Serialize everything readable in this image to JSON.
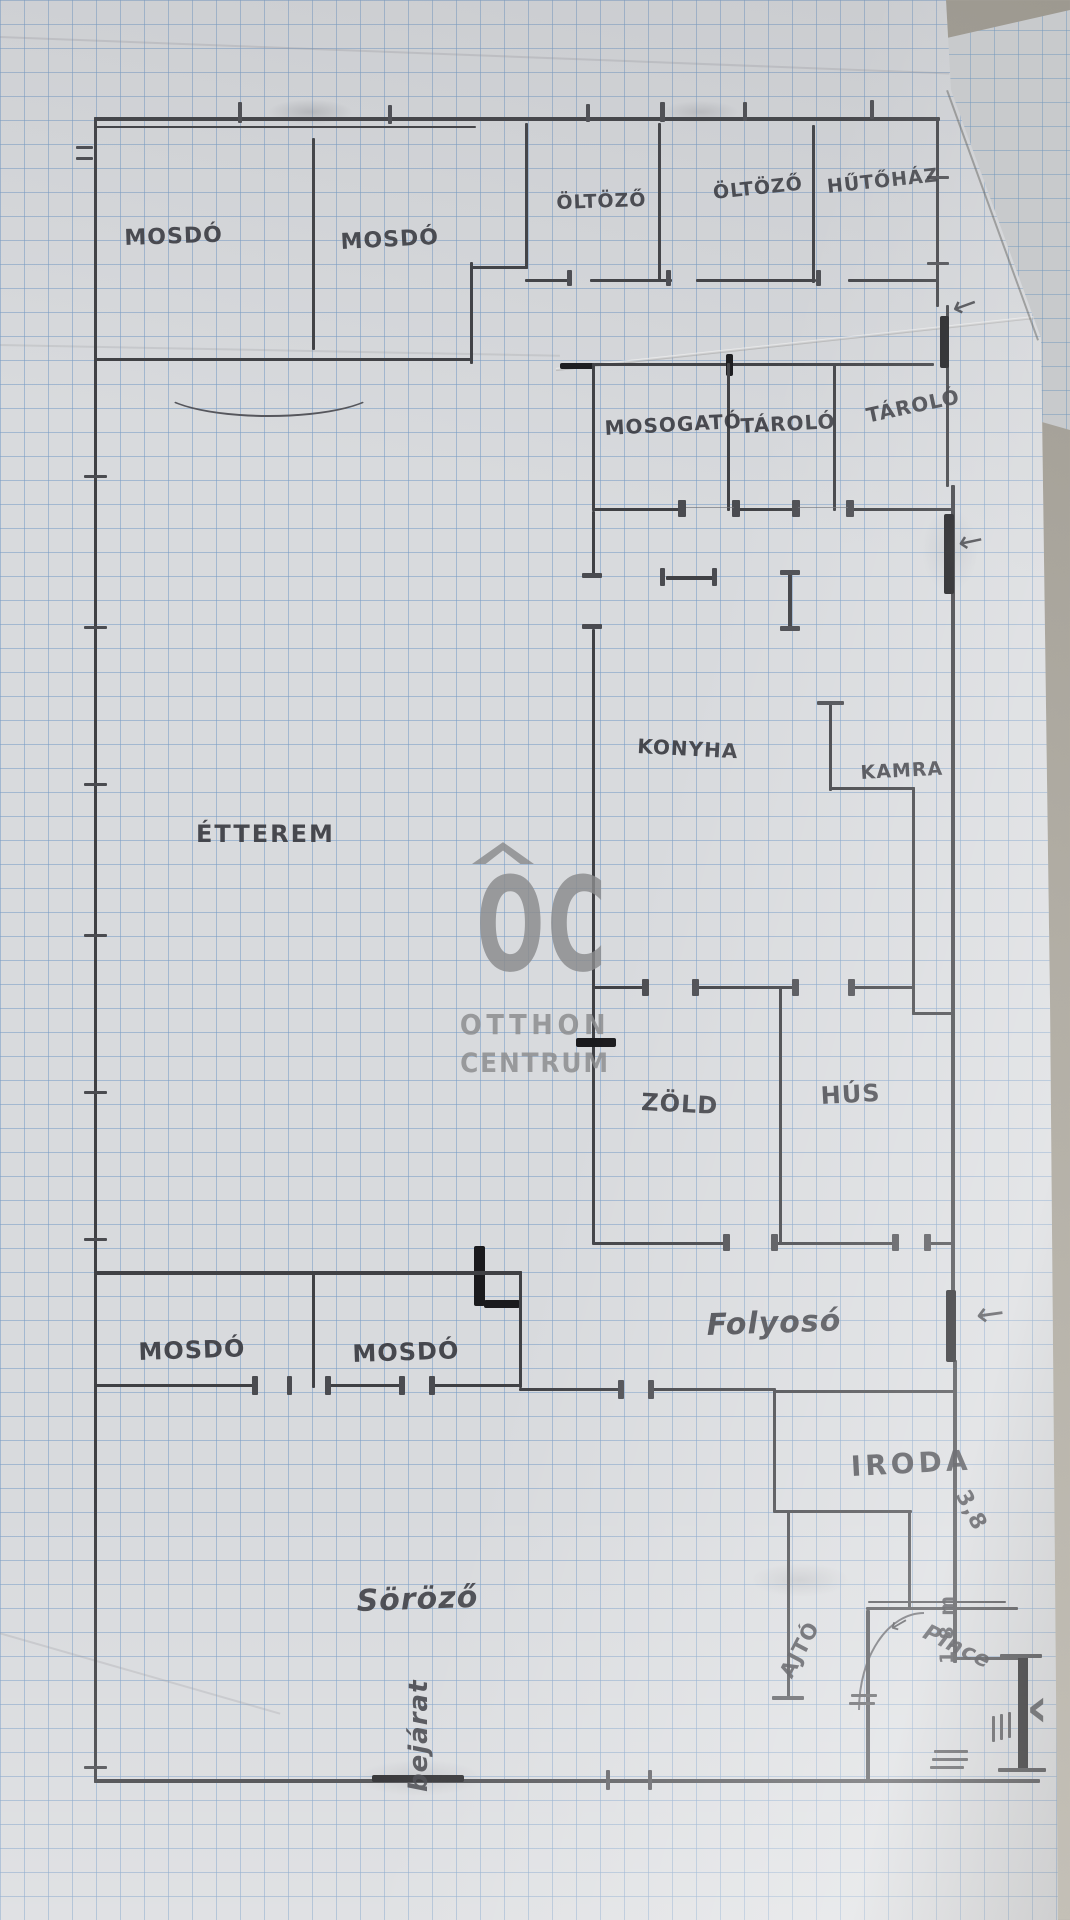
{
  "scene": {
    "description": "Hand-drawn restaurant floor plan sketched in pencil on blue graph paper, photographed lying on a grey table",
    "paper_type": "graph paper"
  },
  "watermark": {
    "mark": "OC",
    "line1": "OTTHON",
    "line2": "CENTRUM"
  },
  "rooms": [
    {
      "id": "mosdo-top-1",
      "label": "MOSDÓ"
    },
    {
      "id": "mosdo-top-2",
      "label": "MOSDÓ"
    },
    {
      "id": "oltozo-1",
      "label": "ÖLTÖZŐ"
    },
    {
      "id": "oltozo-2",
      "label": "ÖLTÖZŐ"
    },
    {
      "id": "hutohaz",
      "label": "HŰTŐHÁZ"
    },
    {
      "id": "mosogato",
      "label": "MOSOGATÓ"
    },
    {
      "id": "tarolo-1",
      "label": "TÁROLÓ"
    },
    {
      "id": "tarolo-2",
      "label": "TÁROLÓ"
    },
    {
      "id": "konyha",
      "label": "KONYHA"
    },
    {
      "id": "kamra",
      "label": "KAMRA"
    },
    {
      "id": "etterem",
      "label": "ÉTTEREM"
    },
    {
      "id": "zold",
      "label": "ZÖLD"
    },
    {
      "id": "hus",
      "label": "HÚS"
    },
    {
      "id": "mosdo-lower-1",
      "label": "MOSDÓ"
    },
    {
      "id": "mosdo-lower-2",
      "label": "MOSDÓ"
    },
    {
      "id": "folyoso",
      "label": "Folyosó"
    },
    {
      "id": "iroda",
      "label": "IRODA"
    },
    {
      "id": "sorozo",
      "label": "Söröző"
    }
  ],
  "annotations": {
    "ajto": "AJTÓ",
    "pince": "Pince",
    "bejarat": "bejárat",
    "dim_iroda": "3,8",
    "dim_cellar": "1,8 m"
  },
  "icons": {
    "arrow_left": "←",
    "chevron_left": "‹"
  },
  "colors": {
    "paper": "#d8dadd",
    "grid_line": "#789cc4",
    "pencil": "#3f4044",
    "pencil_dark": "#1a1a1d",
    "backdrop": "#b2aea5",
    "watermark": "#8a8b8d"
  }
}
